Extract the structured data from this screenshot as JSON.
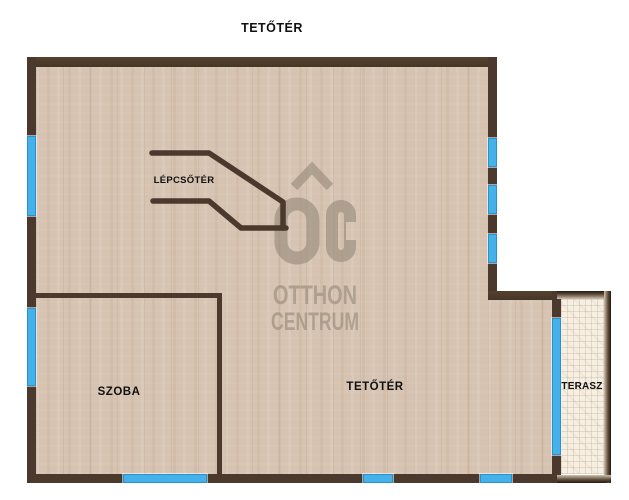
{
  "labels": {
    "floor_title": "TETŐTÉR",
    "stairwell": "LÉPCSŐTÉR",
    "room": "SZOBA",
    "attic": "TETŐTÉR",
    "terrace": "TERASZ"
  },
  "watermark": {
    "monogram": "OC",
    "line1": "OTTHON",
    "line2": "CENTRUM"
  },
  "colors": {
    "wall": "#4a392c",
    "floor": "#d6c3b1",
    "window_blue": "#44b1ea",
    "terrace_floor": "#f6efe3",
    "watermark_gray": "#8e8374",
    "label_text": "#111111"
  }
}
